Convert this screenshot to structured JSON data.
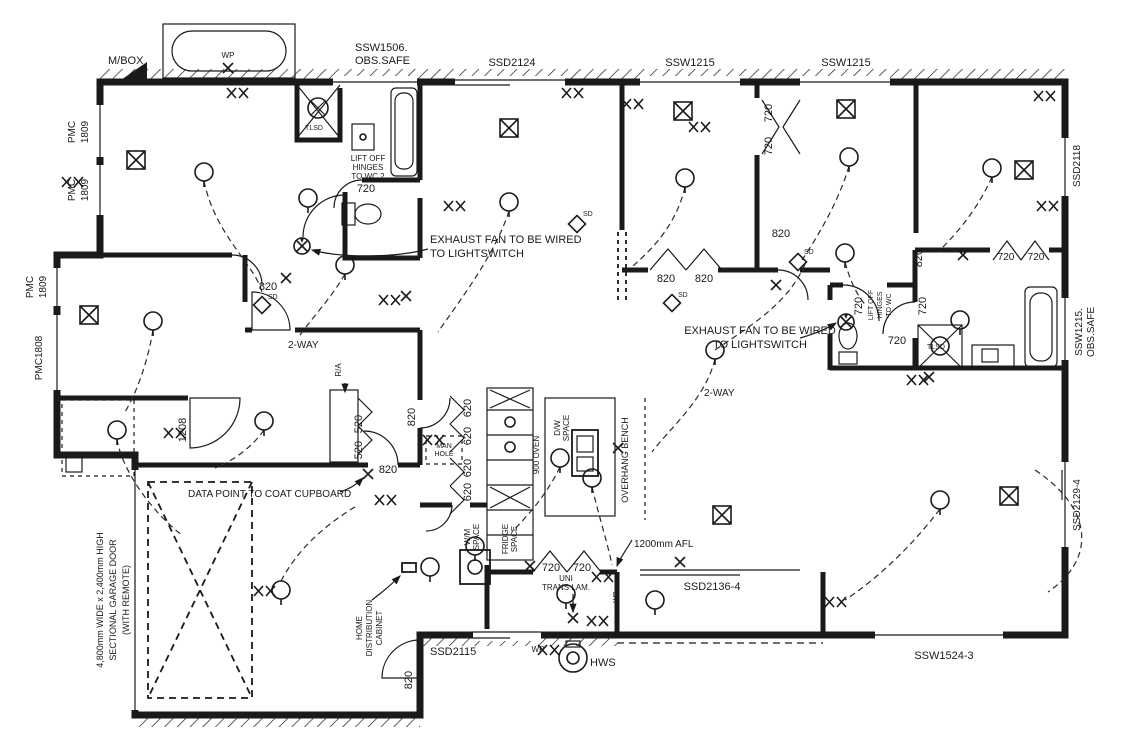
{
  "colors": {
    "ink": "#1a1a1a",
    "paper": "#ffffff"
  },
  "texts": {
    "mbox": "M/BOX",
    "wp": "WP",
    "ssw1506": "SSW1506.",
    "obs_safe": "OBS.SAFE",
    "ssd2124": "SSD2124",
    "ssw1215": "SSW1215",
    "pmc": "PMC",
    "pmc_size": "1809",
    "pmc1808": "PMC1808",
    "ssd2118": "SSD2118",
    "ssw1215_dot": "SSW1215.",
    "ssd2129_4": "SSD2129-4",
    "exhaust_l1": "EXHAUST FAN TO BE WIRED",
    "exhaust_l2": "TO LIGHTSWITCH",
    "lift_off": "LIFT OFF",
    "hinges": "HINGES",
    "to_wc2": "TO WC 2",
    "to_wc": "TO WC",
    "two_way": "2-WAY",
    "ra": "R/A",
    "d820": "820",
    "d720": "720",
    "d620": "620",
    "d520": "520",
    "d1208": "1208",
    "man": "MAN",
    "hole": "HOLE",
    "oven900": "900 OVEN",
    "dw": "D/W",
    "space": "SPACE",
    "wm": "W/M",
    "fridge": "FRIDGE",
    "overhang": "OVERHANG BENCH",
    "afl": "1200mm AFL",
    "uni": "UNI",
    "trans_lam": "TRANS LAM.",
    "ssd2136_4": "SSD2136-4",
    "home": "HOME",
    "distribution": "DISTRIBUTION",
    "cabinet": "CABINET",
    "ssd2115": "SSD2115",
    "hws": "HWS",
    "ssw1524_3": "SSW1524-3",
    "garage_l1": "4,800mm WIDE x 2,400mm HIGH",
    "garage_l2": "SECTIONAL GARAGE DOOR",
    "garage_l3": "(WITH REMOTE)",
    "data_point": "DATA POINT TO COAT CUPBOARD",
    "sd": "SD",
    "tlsd": "TLSD"
  }
}
